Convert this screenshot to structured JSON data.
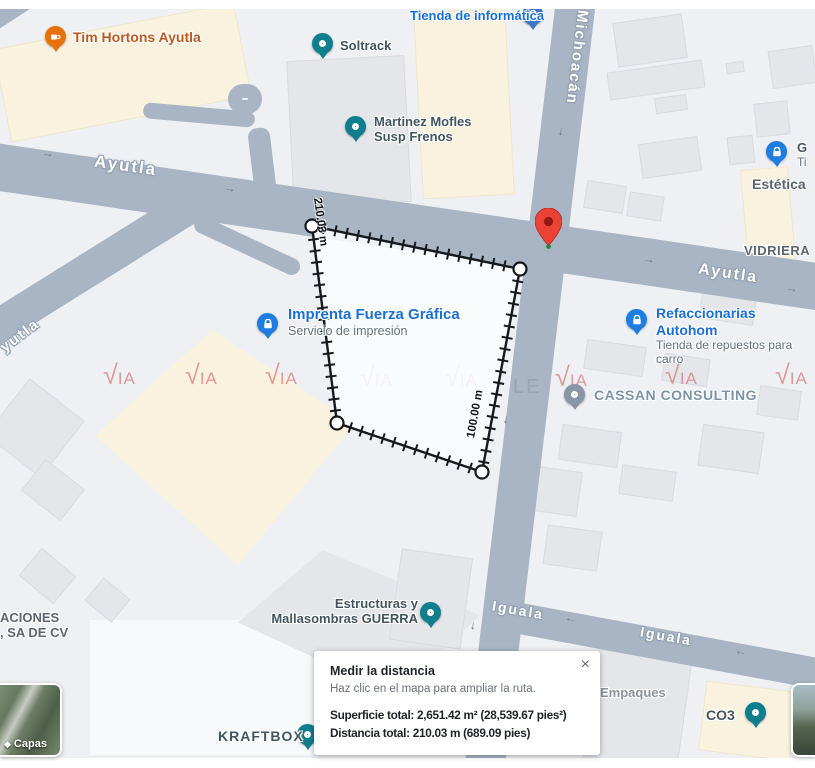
{
  "dialog": {
    "title": "Medir la distancia",
    "hint": "Haz clic en el mapa para ampliar la ruta.",
    "area_total": "Superficie total: 2,651.42 m² (28,539.67 pies²)",
    "distance_total": "Distancia total: 210.03 m (689.09 pies)"
  },
  "measurement": {
    "side_left_label": "210.03 m",
    "side_right_label": "100.00 m"
  },
  "streets": {
    "ayutla_west": "Ayutla",
    "ayutla_east": "Ayutla",
    "ayutla_diagonal": "yutla",
    "michoacan": "Michoacán",
    "iguala_west": "Iguala",
    "iguala_east": "Iguala"
  },
  "pois": {
    "tim_hortons": {
      "label": "Tim Hortons Ayutla"
    },
    "soltrack": {
      "label": "Soltrack"
    },
    "tienda_informatica": {
      "label": "Tienda de informática"
    },
    "martinez": {
      "label": "Martinez Mofles",
      "label2": "Susp Frenos"
    },
    "estetica_g": {
      "label": "G",
      "label2": "Ti"
    },
    "estetica": {
      "label": "Estética"
    },
    "vidriera": {
      "label": "VIDRIERA"
    },
    "imprenta": {
      "label": "Imprenta Fuerza Gráfica",
      "sub": "Servicio de impresión"
    },
    "refaccionarias": {
      "label": "Refaccionarias Autohom",
      "sub": "Tienda de repuestos para carro"
    },
    "cassan": {
      "label": "CASSAN CONSULTING"
    },
    "estructuras": {
      "label": "Estructuras y",
      "label2": "Mallasombras GUERRA"
    },
    "empaques": {
      "label": "Empaques"
    },
    "co3": {
      "label": "CO3"
    },
    "kraftbox": {
      "label": "KRAFTBOX"
    },
    "aciones": {
      "label": "ACIONES",
      "label2": ", SA DE CV"
    }
  },
  "controls": {
    "layers_label": "Capas"
  },
  "watermark": {
    "check": "√",
    "text": "IA",
    "tail_gray": "LE"
  },
  "icons": {
    "close": "×",
    "arrow_right": "→",
    "arrow_left": "←",
    "arrow_down": "↓",
    "layers_diamond": "◆"
  },
  "colors": {
    "road": "#a9b5c4",
    "map_bg": "#eef0f3",
    "building": "#e4e6ea",
    "cream_area": "#f8f2df",
    "poi_blue": "#1a6fd4",
    "pin_teal": "#0f7f8d",
    "pin_blue_lock": "#1e7de0",
    "pin_orange": "#e8710a",
    "pin_gray": "#8a95a5",
    "red_marker": "#ea4335",
    "watermark_red": "#d06464"
  }
}
